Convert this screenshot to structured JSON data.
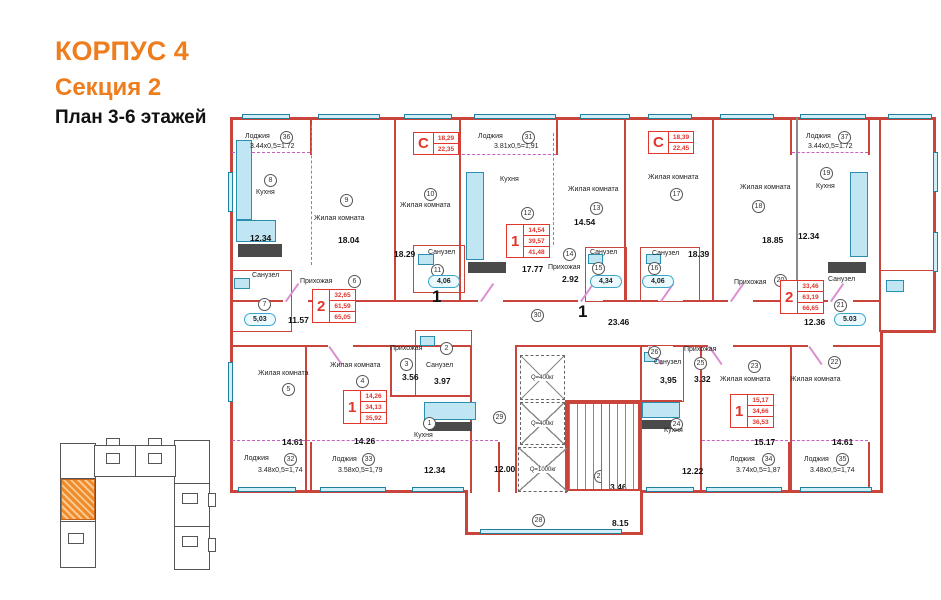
{
  "header": {
    "building": "КОРПУС 4",
    "section": "Секция 2",
    "plan": "План 3-6 этажей"
  },
  "colors": {
    "accent": "#ee7d1d",
    "wall": "#c9453c",
    "apartment_box": "#e2352b",
    "loggia_dash": "#c75fc7",
    "fixture": "#2a8fae",
    "window_fill": "#cfeef7"
  },
  "plan": {
    "apartment_boxes": [
      {
        "type": "С",
        "values": [
          "18,29",
          "22,35"
        ],
        "x": 185,
        "y": 20
      },
      {
        "type": "С",
        "values": [
          "18,39",
          "22,45"
        ],
        "x": 420,
        "y": 19
      },
      {
        "type": "1",
        "values": [
          "14,54",
          "39,57",
          "41,48"
        ],
        "x": 278,
        "y": 112
      },
      {
        "type": "2",
        "values": [
          "32,65",
          "61,59",
          "65,05"
        ],
        "x": 84,
        "y": 177
      },
      {
        "type": "2",
        "values": [
          "33,46",
          "63,19",
          "66,65"
        ],
        "x": 552,
        "y": 168
      },
      {
        "type": "1",
        "values": [
          "14,26",
          "34,13",
          "35,92"
        ],
        "x": 115,
        "y": 278
      },
      {
        "type": "1",
        "values": [
          "15,17",
          "34,66",
          "36,53"
        ],
        "x": 502,
        "y": 282
      }
    ],
    "elevators": [
      {
        "label": "Q=400кг"
      },
      {
        "label": "Q=400кг"
      },
      {
        "label": "Q=1000кг"
      }
    ],
    "labels": [
      {
        "t": "c",
        "v": "36",
        "x": 52,
        "y": 19
      },
      {
        "t": "n",
        "v": "Лоджия",
        "x": 17,
        "y": 21
      },
      {
        "t": "d",
        "v": "3.44x0,5=1.72",
        "x": 22,
        "y": 31
      },
      {
        "t": "c",
        "v": "8",
        "x": 36,
        "y": 62
      },
      {
        "t": "n",
        "v": "Кухня",
        "x": 28,
        "y": 77
      },
      {
        "t": "a",
        "v": "12.34",
        "x": 22,
        "y": 122
      },
      {
        "t": "c",
        "v": "9",
        "x": 112,
        "y": 82
      },
      {
        "t": "n",
        "v": "Жилая комната",
        "x": 86,
        "y": 103
      },
      {
        "t": "a",
        "v": "18.04",
        "x": 110,
        "y": 124
      },
      {
        "t": "c",
        "v": "10",
        "x": 196,
        "y": 76
      },
      {
        "t": "n",
        "v": "Жилая комната",
        "x": 172,
        "y": 90
      },
      {
        "t": "a",
        "v": "18.29",
        "x": 166,
        "y": 138
      },
      {
        "t": "n",
        "v": "Санузел",
        "x": 200,
        "y": 137
      },
      {
        "t": "c",
        "v": "11",
        "x": 203,
        "y": 152
      },
      {
        "t": "tb",
        "v": "4,06",
        "x": 200,
        "y": 163
      },
      {
        "t": "n",
        "v": "Санузел",
        "x": 24,
        "y": 160
      },
      {
        "t": "c",
        "v": "7",
        "x": 30,
        "y": 186
      },
      {
        "t": "tb",
        "v": "5,03",
        "x": 16,
        "y": 201
      },
      {
        "t": "n",
        "v": "Прихожая",
        "x": 72,
        "y": 166
      },
      {
        "t": "c",
        "v": "6",
        "x": 120,
        "y": 163
      },
      {
        "t": "a",
        "v": "11.57",
        "x": 60,
        "y": 204
      },
      {
        "t": "c",
        "v": "31",
        "x": 294,
        "y": 19
      },
      {
        "t": "n",
        "v": "Лоджия",
        "x": 250,
        "y": 21
      },
      {
        "t": "d",
        "v": "3.81x0,5=1,91",
        "x": 266,
        "y": 31
      },
      {
        "t": "n",
        "v": "Кухня",
        "x": 272,
        "y": 64
      },
      {
        "t": "c",
        "v": "12",
        "x": 293,
        "y": 95
      },
      {
        "t": "a",
        "v": "17.77",
        "x": 294,
        "y": 153
      },
      {
        "t": "n",
        "v": "Жилая комната",
        "x": 340,
        "y": 74
      },
      {
        "t": "c",
        "v": "13",
        "x": 362,
        "y": 90
      },
      {
        "t": "a",
        "v": "14.54",
        "x": 346,
        "y": 106
      },
      {
        "t": "c",
        "v": "14",
        "x": 335,
        "y": 136
      },
      {
        "t": "n",
        "v": "Прихожая",
        "x": 320,
        "y": 152
      },
      {
        "t": "a",
        "v": "2.92",
        "x": 334,
        "y": 163
      },
      {
        "t": "n",
        "v": "Санузел",
        "x": 362,
        "y": 137
      },
      {
        "t": "c",
        "v": "15",
        "x": 364,
        "y": 150
      },
      {
        "t": "tb",
        "v": "4,34",
        "x": 362,
        "y": 163
      },
      {
        "t": "n",
        "v": "Санузел",
        "x": 424,
        "y": 138
      },
      {
        "t": "c",
        "v": "16",
        "x": 420,
        "y": 150
      },
      {
        "t": "tb",
        "v": "4,06",
        "x": 414,
        "y": 163
      },
      {
        "t": "n",
        "v": "Жилая комната",
        "x": 420,
        "y": 62
      },
      {
        "t": "c",
        "v": "17",
        "x": 442,
        "y": 76
      },
      {
        "t": "a",
        "v": "18.39",
        "x": 460,
        "y": 138
      },
      {
        "t": "n",
        "v": "Жилая комната",
        "x": 512,
        "y": 72
      },
      {
        "t": "c",
        "v": "18",
        "x": 524,
        "y": 88
      },
      {
        "t": "a",
        "v": "18.85",
        "x": 534,
        "y": 124
      },
      {
        "t": "n",
        "v": "Лоджия",
        "x": 578,
        "y": 21
      },
      {
        "t": "c",
        "v": "37",
        "x": 610,
        "y": 19
      },
      {
        "t": "d",
        "v": "3.44x0,5=1.72",
        "x": 580,
        "y": 31
      },
      {
        "t": "c",
        "v": "19",
        "x": 592,
        "y": 55
      },
      {
        "t": "n",
        "v": "Кухня",
        "x": 588,
        "y": 71
      },
      {
        "t": "a",
        "v": "12.34",
        "x": 570,
        "y": 120
      },
      {
        "t": "n",
        "v": "Прихожая",
        "x": 506,
        "y": 167
      },
      {
        "t": "c",
        "v": "20",
        "x": 546,
        "y": 162
      },
      {
        "t": "a",
        "v": "12.36",
        "x": 576,
        "y": 206
      },
      {
        "t": "c",
        "v": "21",
        "x": 606,
        "y": 187
      },
      {
        "t": "n",
        "v": "Санузел",
        "x": 600,
        "y": 164
      },
      {
        "t": "tb",
        "v": "5.03",
        "x": 606,
        "y": 201
      },
      {
        "t": "c",
        "v": "30",
        "x": 303,
        "y": 197
      },
      {
        "t": "a",
        "v": "23.46",
        "x": 380,
        "y": 206
      },
      {
        "t": "m",
        "v": "1",
        "x": 204,
        "y": 176
      },
      {
        "t": "m",
        "v": "1",
        "x": 350,
        "y": 191
      },
      {
        "t": "c",
        "v": "29",
        "x": 265,
        "y": 299
      },
      {
        "t": "a",
        "v": "12.00",
        "x": 266,
        "y": 353
      },
      {
        "t": "c",
        "v": "27",
        "x": 366,
        "y": 358
      },
      {
        "t": "a",
        "v": "3.46",
        "x": 382,
        "y": 371
      },
      {
        "t": "c",
        "v": "28",
        "x": 304,
        "y": 402
      },
      {
        "t": "a",
        "v": "8.15",
        "x": 384,
        "y": 407
      },
      {
        "t": "c",
        "v": "5",
        "x": 54,
        "y": 271
      },
      {
        "t": "n",
        "v": "Жилая комната",
        "x": 30,
        "y": 258
      },
      {
        "t": "a",
        "v": "14.61",
        "x": 54,
        "y": 326
      },
      {
        "t": "n",
        "v": "Лоджия",
        "x": 16,
        "y": 343
      },
      {
        "t": "c",
        "v": "32",
        "x": 56,
        "y": 341
      },
      {
        "t": "d",
        "v": "3.48x0,5=1,74",
        "x": 30,
        "y": 355
      },
      {
        "t": "c",
        "v": "4",
        "x": 128,
        "y": 263
      },
      {
        "t": "n",
        "v": "Жилая комната",
        "x": 102,
        "y": 250
      },
      {
        "t": "a",
        "v": "14.26",
        "x": 126,
        "y": 325
      },
      {
        "t": "n",
        "v": "Лоджия",
        "x": 104,
        "y": 344
      },
      {
        "t": "c",
        "v": "33",
        "x": 134,
        "y": 341
      },
      {
        "t": "d",
        "v": "3.58x0,5=1,79",
        "x": 110,
        "y": 355
      },
      {
        "t": "n",
        "v": "Прихожая",
        "x": 162,
        "y": 233
      },
      {
        "t": "c",
        "v": "3",
        "x": 172,
        "y": 246
      },
      {
        "t": "a",
        "v": "3.56",
        "x": 174,
        "y": 261
      },
      {
        "t": "c",
        "v": "2",
        "x": 212,
        "y": 230
      },
      {
        "t": "n",
        "v": "Санузел",
        "x": 198,
        "y": 250
      },
      {
        "t": "a",
        "v": "3.97",
        "x": 206,
        "y": 265
      },
      {
        "t": "c",
        "v": "1",
        "x": 195,
        "y": 305
      },
      {
        "t": "n",
        "v": "Кухня",
        "x": 186,
        "y": 320
      },
      {
        "t": "a",
        "v": "12.34",
        "x": 196,
        "y": 354
      },
      {
        "t": "c",
        "v": "26",
        "x": 420,
        "y": 234
      },
      {
        "t": "n",
        "v": "Санузел",
        "x": 426,
        "y": 247
      },
      {
        "t": "a",
        "v": "3,95",
        "x": 432,
        "y": 264
      },
      {
        "t": "n",
        "v": "Прихожая",
        "x": 456,
        "y": 234
      },
      {
        "t": "c",
        "v": "25",
        "x": 466,
        "y": 245
      },
      {
        "t": "a",
        "v": "3.32",
        "x": 466,
        "y": 263
      },
      {
        "t": "c",
        "v": "24",
        "x": 442,
        "y": 306
      },
      {
        "t": "n",
        "v": "Кухня",
        "x": 436,
        "y": 315
      },
      {
        "t": "a",
        "v": "12.22",
        "x": 454,
        "y": 355
      },
      {
        "t": "c",
        "v": "23",
        "x": 520,
        "y": 248
      },
      {
        "t": "n",
        "v": "Жилая комната",
        "x": 492,
        "y": 264
      },
      {
        "t": "a",
        "v": "15.17",
        "x": 526,
        "y": 326
      },
      {
        "t": "n",
        "v": "Лоджия",
        "x": 502,
        "y": 344
      },
      {
        "t": "c",
        "v": "34",
        "x": 534,
        "y": 341
      },
      {
        "t": "d",
        "v": "3.74x0,5=1,87",
        "x": 508,
        "y": 355
      },
      {
        "t": "c",
        "v": "22",
        "x": 600,
        "y": 244
      },
      {
        "t": "n",
        "v": "Жилая комната",
        "x": 562,
        "y": 264
      },
      {
        "t": "a",
        "v": "14.61",
        "x": 604,
        "y": 326
      },
      {
        "t": "n",
        "v": "Лоджия",
        "x": 576,
        "y": 344
      },
      {
        "t": "c",
        "v": "35",
        "x": 608,
        "y": 341
      },
      {
        "t": "d",
        "v": "3.48x0,5=1,74",
        "x": 582,
        "y": 355
      }
    ]
  }
}
